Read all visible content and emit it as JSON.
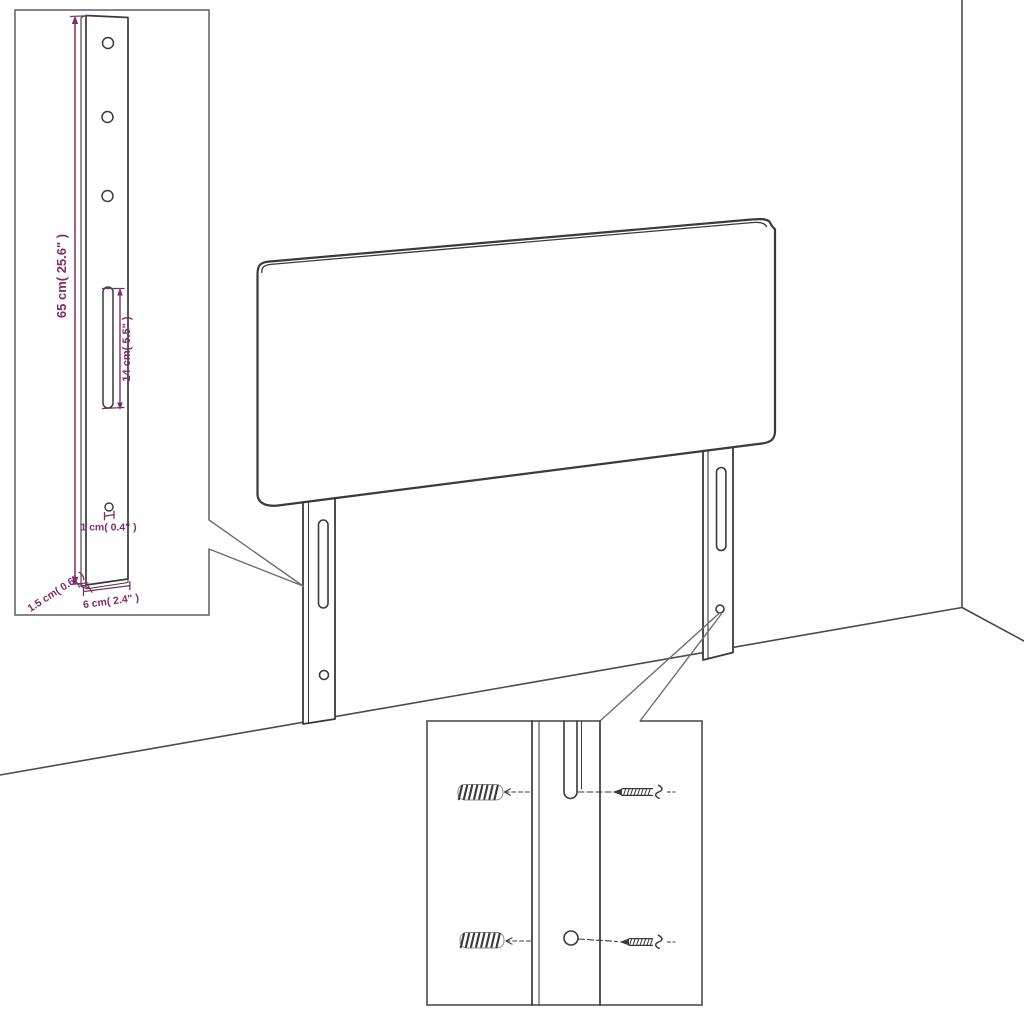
{
  "colors": {
    "background": "#ffffff",
    "line": "#3a3a3a",
    "wall_line": "#4a4a4a",
    "inset_border": "#5f5f5f",
    "dimension": "#832c6b"
  },
  "leg_detail": {
    "labels": {
      "height": "65 cm( 25.6\" )",
      "slot": "14 cm( 5.5\" )",
      "hole": "1 cm( 0.4\" )",
      "thickness": "1.5 cm( 0.6\" )",
      "width": "6 cm( 2.4\" )"
    }
  }
}
